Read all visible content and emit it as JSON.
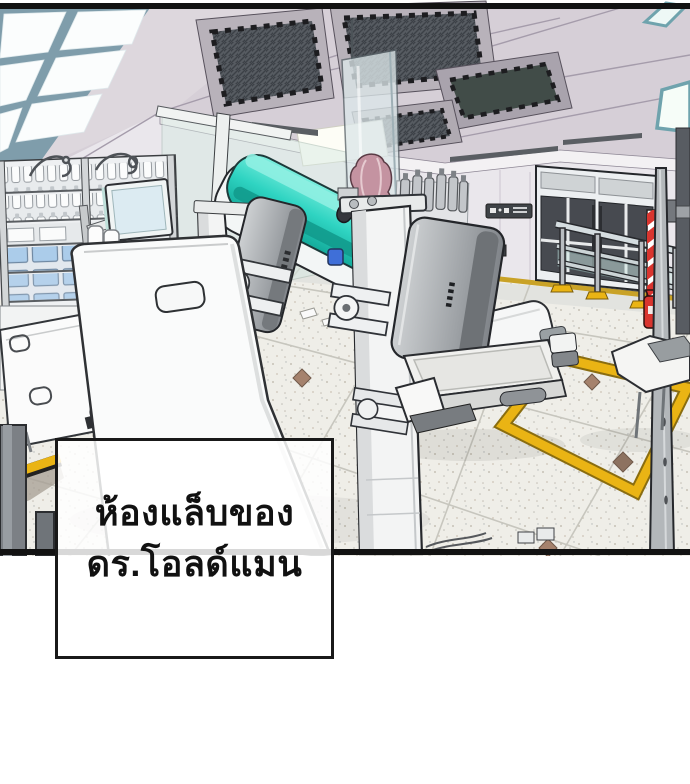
{
  "panel": {
    "kind": "webtoon-scene-panel",
    "caption": {
      "line1": "ห้องแล็บของ",
      "line2": "ดร.โอลด์แมน"
    }
  },
  "palette": {
    "ink_outline": "#26282c",
    "ceiling_lavender": "#d6cfd7",
    "wall_light": "#eae7ec",
    "floor_terrazzo": "#efeee8",
    "machine_teal": "#2fd4c2",
    "machine_teal_light": "#8ff0e2",
    "machine_teal_dark": "#129b8d",
    "safety_yellow": "#eab414",
    "floor_line_yellow": "#c9a227",
    "stripe_red": "#d9352f",
    "hair_pink": "#c493a1",
    "tray_blue": "#abccea",
    "bucket_blue": "#3f6fd8",
    "door_glass_dark": "#474a50",
    "skylight_frame": "#7f9dab",
    "glass_green": "#d8eae3"
  }
}
